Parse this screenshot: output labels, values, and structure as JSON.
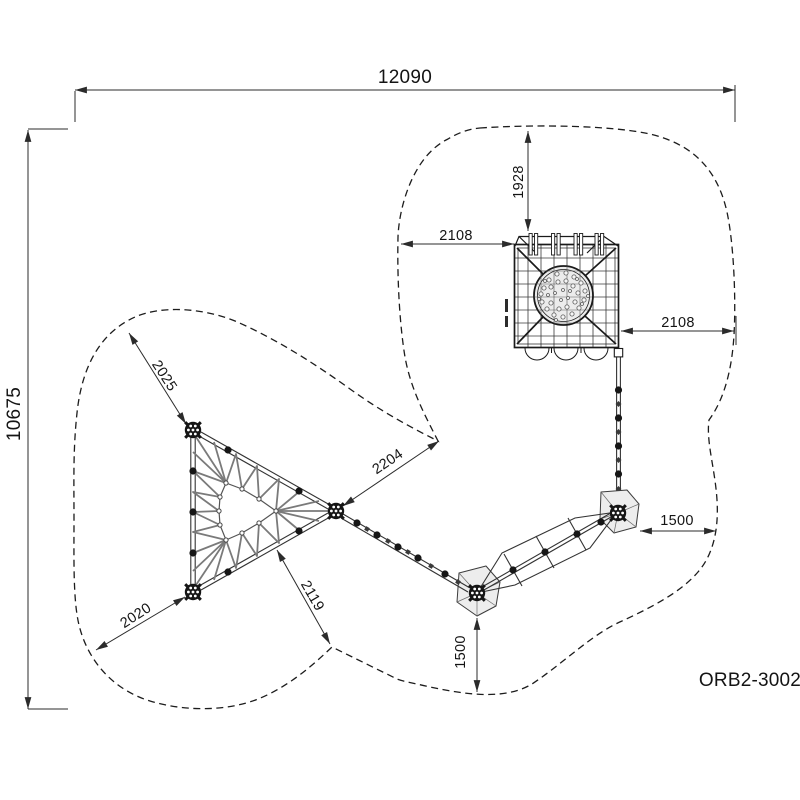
{
  "meta": {
    "product_code": "ORB2-3002"
  },
  "dimensions": {
    "overall": {
      "width": "12090",
      "height": "10675"
    },
    "tower": {
      "top_clearance": "1928",
      "left_clearance": "2108",
      "right_clearance": "2108"
    },
    "triangle": {
      "upper_left_clearance": "2025",
      "to_boundary_right": "2204",
      "lower_left_clearance": "2020",
      "lower_right_clearance": "2119"
    },
    "pads": {
      "bottom_clearance": "1500",
      "right_clearance": "1500"
    }
  },
  "colors": {
    "background": "#ffffff",
    "line": "#1c1c1c",
    "dimension_line": "#2b2b2b",
    "rope": "#7a7a7a",
    "pad_fill": "#ededed",
    "ball_fill": "#ececec"
  }
}
